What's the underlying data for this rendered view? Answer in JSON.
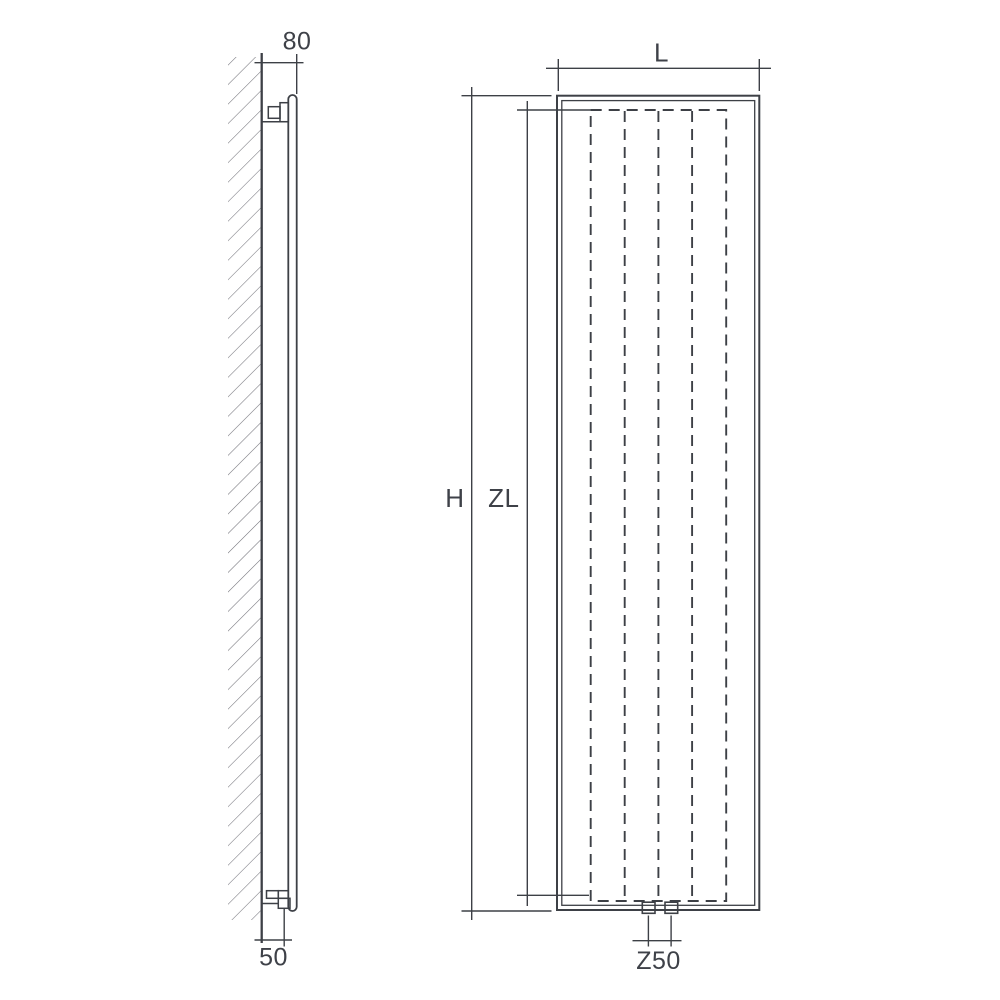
{
  "drawing": {
    "type": "technical-drawing-vertical-radiator",
    "colors": {
      "background": "#ffffff",
      "ink": "#3d4046",
      "hatch": "#73737b"
    },
    "side_view": {
      "labels": {
        "wall_depth": "80",
        "bottom_connection_offset": "50"
      }
    },
    "front_view": {
      "labels": {
        "width": "L",
        "height": "H",
        "panel_height": "ZL",
        "connection_spacing": "Z50"
      }
    }
  }
}
